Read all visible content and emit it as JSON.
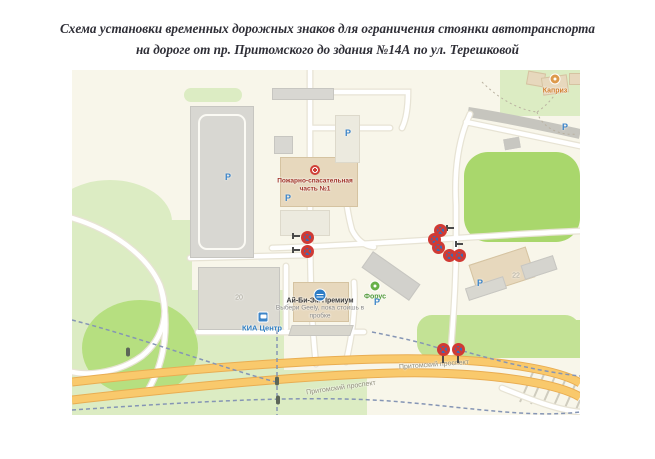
{
  "title": {
    "line1": "Схема установки временных дорожных знаков для ограничения стоянки автотранспорта",
    "line2": "на дороге от пр. Притомского до здания №14А по ул. Терешковой"
  },
  "map": {
    "pois": {
      "fire_station": {
        "line1": "Пожарно-спасательная",
        "line2": "часть №1"
      },
      "kapriz": "Каприз",
      "forus": "Форус",
      "kia_center": "КИА Центр",
      "ibm": {
        "name": "Ай-Би-Эм Премиум",
        "ad_line1": "Выбери Geely, пока стоишь в",
        "ad_line2": "пробке"
      },
      "building_20": "20",
      "building_22": "22"
    },
    "roads": {
      "avenue_label_left": "Притомский проспект",
      "avenue_label_right": "Притомский проспект"
    },
    "parking_letter": "Р",
    "parking_positions": [
      [
        156,
        107
      ],
      [
        276,
        63
      ],
      [
        216,
        128
      ],
      [
        305,
        232
      ],
      [
        408,
        213
      ],
      [
        493,
        57
      ]
    ],
    "traffic_lights": [
      [
        56,
        282
      ],
      [
        205,
        311
      ],
      [
        206,
        330
      ]
    ],
    "sign_clusters": [
      {
        "id": "north-driveway",
        "posts": false,
        "signs": [
          [
            235,
            167
          ],
          [
            235,
            181
          ]
        ]
      },
      {
        "id": "crossroad",
        "posts": false,
        "signs": [
          [
            368,
            160
          ],
          [
            362,
            169
          ],
          [
            366,
            177
          ],
          [
            377,
            185
          ],
          [
            387,
            185
          ]
        ]
      },
      {
        "id": "avenue",
        "posts": true,
        "signs": [
          [
            371,
            279
          ],
          [
            386,
            279
          ]
        ]
      }
    ],
    "colors": {
      "map_background": "#f8f6ea",
      "green_pale": "#dcecc3",
      "green_bright": "#a9d76c",
      "green_mound": "#b6df80",
      "road_white": "#ffffff",
      "road_casing": "#e7e3d4",
      "avenue_fill": "#f9c96c",
      "avenue_casing": "#e9ad52",
      "gray_road": "#c6c5be",
      "sign_red": "#d03a34",
      "sign_blue": "#2f6fc0",
      "parking_blue": "#3d85c8",
      "route_dash": "#8595b5"
    }
  }
}
